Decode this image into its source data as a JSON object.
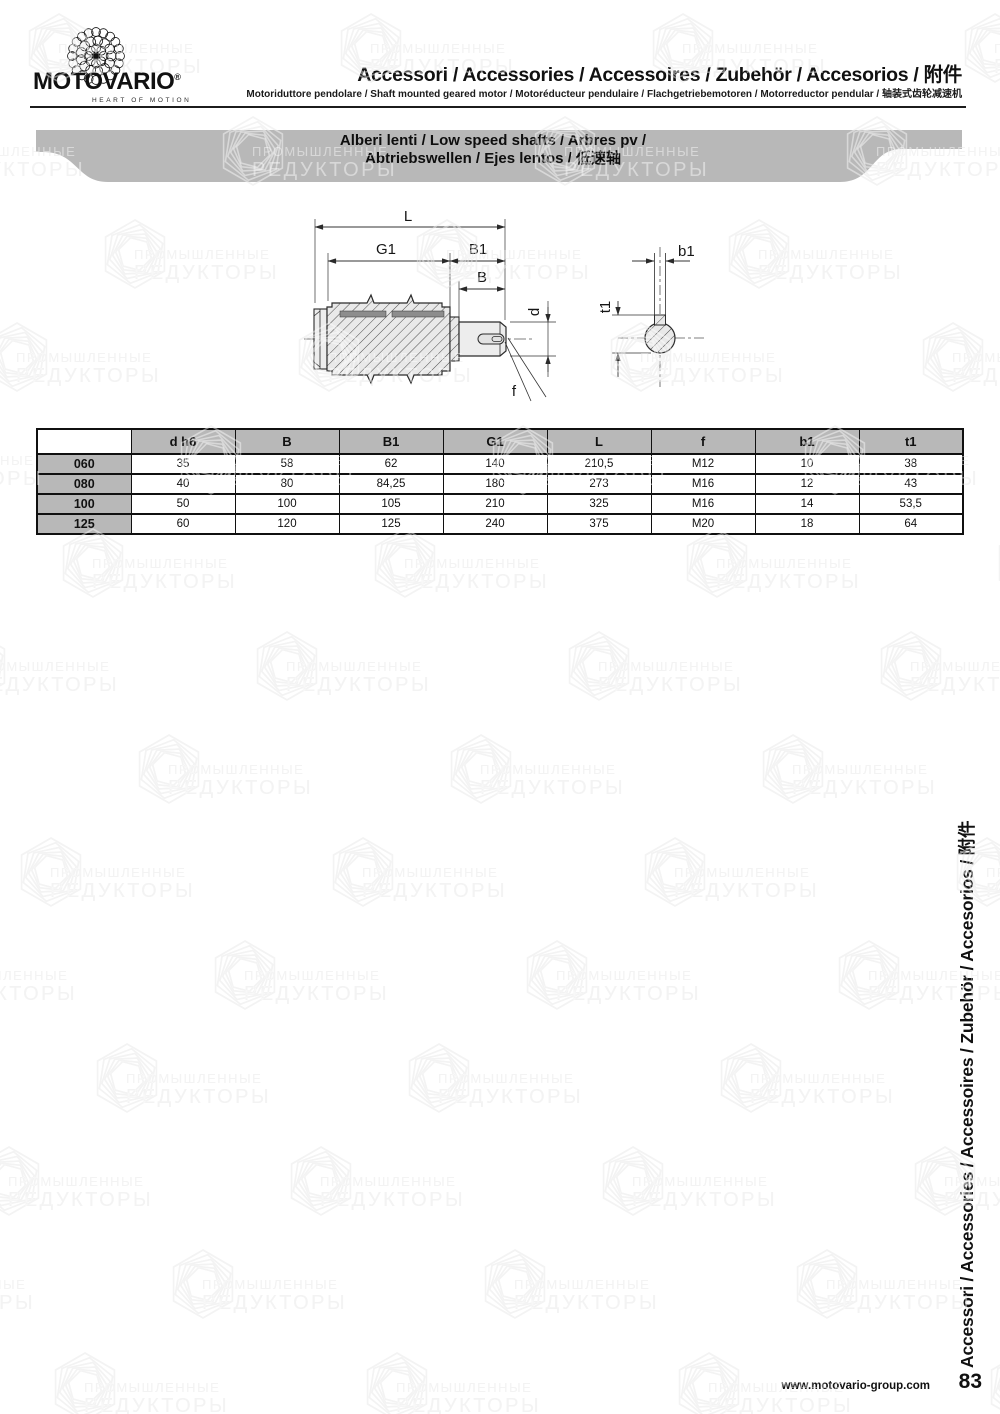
{
  "brand": {
    "name": "MOTOVARIO",
    "registered": "®",
    "tagline": "HEART OF MOTION"
  },
  "header": {
    "title": "Accessori / Accessories / Accessoires / Zubehör / Accesorios / 附件",
    "subtitle": "Motoriduttore pendolare / Shaft mounted geared motor / Motoréducteur pendulaire / Flachgetriebemotoren / Motorreductor pendular / 轴装式齿轮减速机"
  },
  "banner": {
    "line1": "Alberi lenti / Low speed shafts / Arbres pv /",
    "line2": "Abtriebswellen / Ejes lentos / 低速轴"
  },
  "drawing": {
    "labels": {
      "L": "L",
      "G1": "G1",
      "B1": "B1",
      "B": "B",
      "d": "d",
      "f": "f",
      "b1": "b1",
      "t1": "t1"
    }
  },
  "table": {
    "columns": [
      "",
      "d h6",
      "B",
      "B1",
      "G1",
      "L",
      "f",
      "b1",
      "t1"
    ],
    "rows": [
      {
        "model": "060",
        "values": [
          "35",
          "58",
          "62",
          "140",
          "210,5",
          "M12",
          "10",
          "38"
        ]
      },
      {
        "model": "080",
        "values": [
          "40",
          "80",
          "84,25",
          "180",
          "273",
          "M16",
          "12",
          "43"
        ]
      },
      {
        "model": "100",
        "values": [
          "50",
          "100",
          "105",
          "210",
          "325",
          "M16",
          "14",
          "53,5"
        ]
      },
      {
        "model": "125",
        "values": [
          "60",
          "120",
          "125",
          "240",
          "375",
          "M20",
          "18",
          "64"
        ]
      }
    ]
  },
  "sidebar": {
    "text": "Accessori / Accessories / Accessoires / Zubehör / Accesorios / 附件"
  },
  "footer": {
    "website": "www.motovario-group.com",
    "page_number": "83"
  },
  "watermark": {
    "line1": "ПРОМЫШЛЕННЫЕ",
    "line2": "РЕДУКТОРЫ"
  },
  "colors": {
    "banner_gray": "#b8b8b8",
    "table_header_gray": "#b8b8b8",
    "line_black": "#1c1c1c"
  }
}
